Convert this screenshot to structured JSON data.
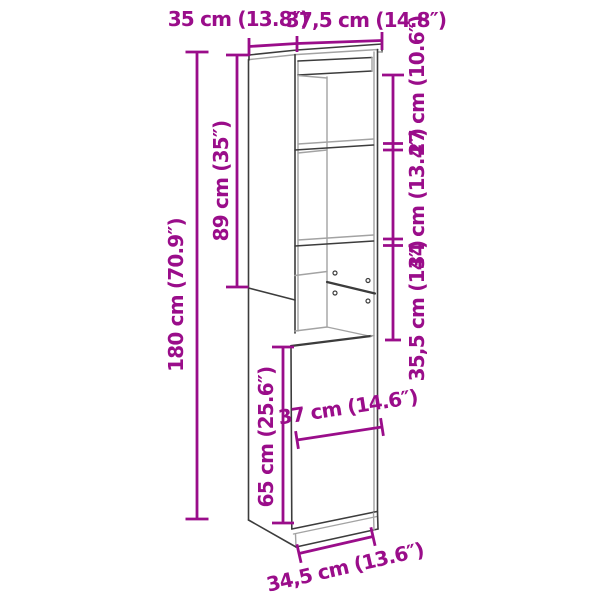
{
  "title": "Highboard dimension diagram",
  "colors": {
    "dimension": "#9a0d8a",
    "outline": "#3c3c3c",
    "outline-light": "#a3a3a3",
    "background": "#ffffff"
  },
  "dimensions": {
    "top_depth": "35 cm (13.8″)",
    "top_width": "37,5 cm (14.8″)",
    "upper_section_height": "89 cm (35″)",
    "total_height": "180 cm (70.9″)",
    "compartment_top": "27 cm (10.6″)",
    "compartment_middle": "34 cm (13.4″)",
    "compartment_bottom": "35,5 cm (14″)",
    "door_height": "65 cm (25.6″)",
    "door_width": "37 cm (14.6″)",
    "base_width": "34,5 cm (13.6″)"
  }
}
